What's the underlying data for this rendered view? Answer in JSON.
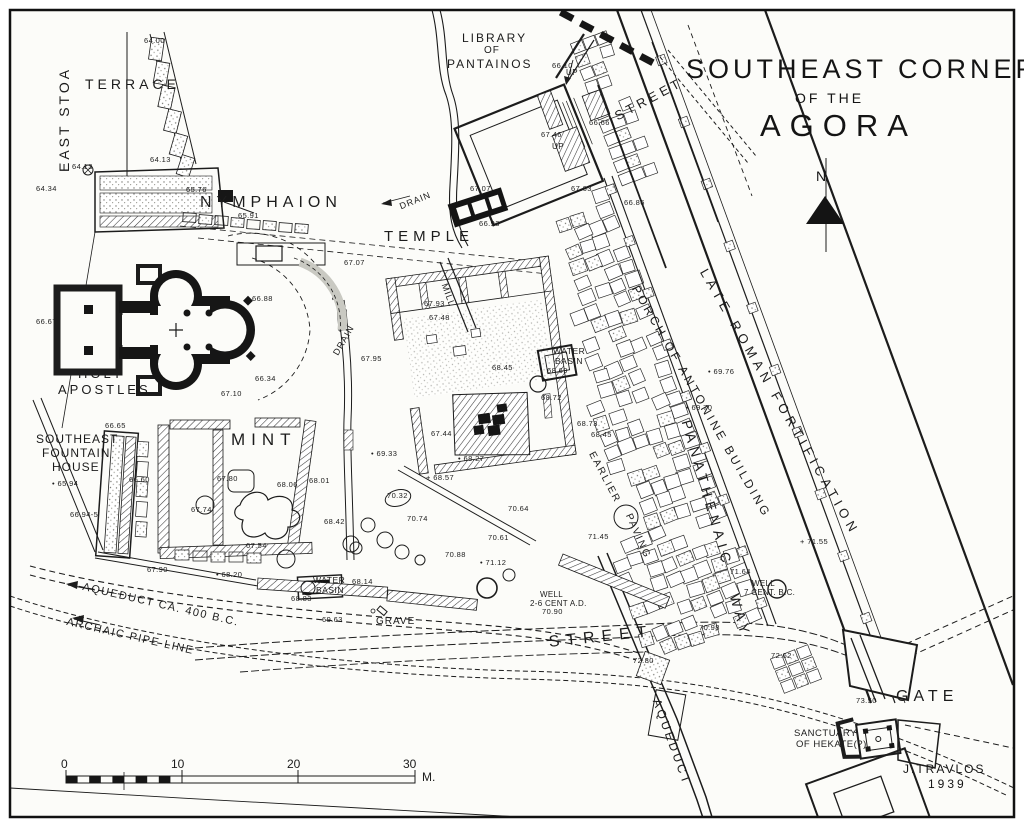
{
  "title": {
    "line1": "SOUTHEAST CORNER",
    "line2": "OF THE",
    "line3": "AGORA"
  },
  "compass": {
    "north": "N"
  },
  "attribution": {
    "author": "J.TRAVLOS",
    "year": "1939"
  },
  "scale_bar": {
    "unit": "M.",
    "ticks": [
      {
        "label": "0",
        "x": 61
      },
      {
        "label": "10",
        "x": 171
      },
      {
        "label": "20",
        "x": 287
      },
      {
        "label": "30",
        "x": 403
      }
    ]
  },
  "colors": {
    "ink": "#1c1c1c",
    "paper": "#fcfcf9"
  },
  "labels": [
    {
      "t": "EAST STOA",
      "x": 56,
      "y": 172,
      "r": -90,
      "s": 14,
      "ls": 3
    },
    {
      "t": "TERRACE",
      "x": 85,
      "y": 76,
      "s": 14,
      "ls": 4
    },
    {
      "t": "NYMPHAION",
      "x": 200,
      "y": 194,
      "s": 16,
      "ls": 5
    },
    {
      "t": "LIBRARY",
      "x": 462,
      "y": 31,
      "s": 12,
      "ls": 2
    },
    {
      "t": "OF",
      "x": 484,
      "y": 45,
      "s": 10,
      "ls": 1
    },
    {
      "t": "PANTAINOS",
      "x": 447,
      "y": 57,
      "s": 12,
      "ls": 2
    },
    {
      "t": "STREET",
      "x": 612,
      "y": 110,
      "r": -28,
      "s": 13,
      "ls": 4
    },
    {
      "t": "UP",
      "x": 566,
      "y": 68,
      "s": 8,
      "ls": 0.5
    },
    {
      "t": "UP",
      "x": 552,
      "y": 142,
      "s": 8,
      "ls": 0.5
    },
    {
      "t": "DRAIN",
      "x": 398,
      "y": 202,
      "r": -22,
      "s": 9,
      "ls": 1
    },
    {
      "t": "TEMPLE",
      "x": 384,
      "y": 228,
      "s": 15,
      "ls": 5
    },
    {
      "t": "MILL",
      "x": 449,
      "y": 282,
      "r": 70,
      "s": 9,
      "ls": 1
    },
    {
      "t": "DRAIN",
      "x": 331,
      "y": 352,
      "r": -60,
      "s": 9,
      "ls": 1
    },
    {
      "t": "HOLY",
      "x": 78,
      "y": 366,
      "s": 13,
      "ls": 3
    },
    {
      "t": "APOSTLES",
      "x": 58,
      "y": 382,
      "s": 13,
      "ls": 3
    },
    {
      "t": "SOUTHEAST",
      "x": 36,
      "y": 432,
      "s": 12,
      "ls": 1
    },
    {
      "t": "FOUNTAIN",
      "x": 42,
      "y": 446,
      "s": 12,
      "ls": 1
    },
    {
      "t": "HOUSE",
      "x": 52,
      "y": 460,
      "s": 12,
      "ls": 1
    },
    {
      "t": "MINT",
      "x": 231,
      "y": 430,
      "s": 17,
      "ls": 6
    },
    {
      "t": "WATER",
      "x": 553,
      "y": 346,
      "s": 8.5,
      "ls": 0.5
    },
    {
      "t": "BASIN",
      "x": 555,
      "y": 356,
      "s": 8.5,
      "ls": 0.5
    },
    {
      "t": "WATER",
      "x": 313,
      "y": 575,
      "s": 8.5,
      "ls": 0.5
    },
    {
      "t": "BASIN",
      "x": 316,
      "y": 585,
      "s": 8.5,
      "ls": 0.5
    },
    {
      "t": "PORCH OF ANTONINE BUILDING",
      "x": 641,
      "y": 283,
      "r": 60,
      "s": 12,
      "ls": 3
    },
    {
      "t": "LATE ROMAN FORTIFICATION",
      "x": 710,
      "y": 266,
      "r": 60,
      "s": 13,
      "ls": 5
    },
    {
      "t": "EARLIER",
      "x": 596,
      "y": 450,
      "r": 62,
      "s": 10,
      "ls": 2
    },
    {
      "t": "PAVING",
      "x": 633,
      "y": 512,
      "r": 66,
      "s": 10,
      "ls": 2
    },
    {
      "t": "PANATHENAIC",
      "x": 694,
      "y": 418,
      "r": 74,
      "s": 14,
      "ls": 5
    },
    {
      "t": "WAY",
      "x": 742,
      "y": 592,
      "r": 74,
      "s": 14,
      "ls": 5
    },
    {
      "t": "WELL",
      "x": 540,
      "y": 590,
      "s": 8,
      "ls": 0.3
    },
    {
      "t": "2-6 CENT A.D.",
      "x": 530,
      "y": 599,
      "s": 8,
      "ls": 0.3
    },
    {
      "t": "WELL",
      "x": 752,
      "y": 579,
      "s": 8,
      "ls": 0.3
    },
    {
      "t": "7 CENT. B.C.",
      "x": 744,
      "y": 588,
      "s": 8,
      "ls": 0.3
    },
    {
      "t": "GRAVE",
      "x": 376,
      "y": 616,
      "s": 10,
      "ls": 1
    },
    {
      "t": "STREET",
      "x": 548,
      "y": 634,
      "r": -6,
      "s": 16,
      "ls": 7
    },
    {
      "t": "AQUEDUCT CA. 400 B.C.",
      "x": 84,
      "y": 581,
      "r": 13,
      "s": 11,
      "ls": 1.5
    },
    {
      "t": "ARCHAIC PIPE LINE",
      "x": 68,
      "y": 616,
      "r": 13,
      "s": 11,
      "ls": 1.5
    },
    {
      "t": "AQUEDUCT",
      "x": 663,
      "y": 697,
      "r": 70,
      "s": 12,
      "ls": 3
    },
    {
      "t": "GATE",
      "x": 896,
      "y": 688,
      "s": 16,
      "ls": 5
    },
    {
      "t": "SANCTUARY",
      "x": 794,
      "y": 728,
      "s": 9.5,
      "ls": 0.5
    },
    {
      "t": "OF HEKATE(?)",
      "x": 796,
      "y": 739,
      "s": 9.5,
      "ls": 0.5
    }
  ],
  "elevations": [
    {
      "t": "64.00",
      "x": 144,
      "y": 36
    },
    {
      "t": "64.13",
      "x": 150,
      "y": 155
    },
    {
      "t": "64.13",
      "x": 72,
      "y": 162
    },
    {
      "t": "64.34",
      "x": 36,
      "y": 184
    },
    {
      "t": "65.76",
      "x": 186,
      "y": 185
    },
    {
      "t": "65.91",
      "x": 238,
      "y": 211
    },
    {
      "t": "66.10",
      "x": 552,
      "y": 61
    },
    {
      "t": "67.46",
      "x": 541,
      "y": 130
    },
    {
      "t": "66.66",
      "x": 589,
      "y": 118
    },
    {
      "t": "67.63",
      "x": 571,
      "y": 184
    },
    {
      "t": "66.86",
      "x": 624,
      "y": 198
    },
    {
      "t": "67.07",
      "x": 470,
      "y": 184
    },
    {
      "t": "66.93",
      "x": 479,
      "y": 219
    },
    {
      "t": "67.07",
      "x": 344,
      "y": 258
    },
    {
      "t": "66.88",
      "x": 252,
      "y": 294
    },
    {
      "t": "66.67",
      "x": 36,
      "y": 317
    },
    {
      "t": "66.34",
      "x": 255,
      "y": 374
    },
    {
      "t": "67.10",
      "x": 221,
      "y": 389
    },
    {
      "t": "66.65",
      "x": 105,
      "y": 421
    },
    {
      "t": "• 65.94",
      "x": 52,
      "y": 479
    },
    {
      "t": "66.60",
      "x": 129,
      "y": 475
    },
    {
      "t": "66.94-5",
      "x": 70,
      "y": 510
    },
    {
      "t": "67.80",
      "x": 217,
      "y": 474
    },
    {
      "t": "68.06",
      "x": 277,
      "y": 480
    },
    {
      "t": "68.01",
      "x": 309,
      "y": 476
    },
    {
      "t": "67.74",
      "x": 191,
      "y": 505
    },
    {
      "t": "67.54",
      "x": 246,
      "y": 541
    },
    {
      "t": "67.90",
      "x": 147,
      "y": 565
    },
    {
      "t": "• 68.20",
      "x": 216,
      "y": 570
    },
    {
      "t": "68.83",
      "x": 291,
      "y": 594
    },
    {
      "t": "69.63",
      "x": 322,
      "y": 615
    },
    {
      "t": "68.14",
      "x": 352,
      "y": 577
    },
    {
      "t": "68.42",
      "x": 324,
      "y": 517
    },
    {
      "t": "• 69.33",
      "x": 371,
      "y": 449
    },
    {
      "t": "67.95",
      "x": 361,
      "y": 354
    },
    {
      "t": "67.93",
      "x": 424,
      "y": 299
    },
    {
      "t": "67.48",
      "x": 429,
      "y": 313
    },
    {
      "t": "67.44",
      "x": 431,
      "y": 429
    },
    {
      "t": "+ 68.57",
      "x": 426,
      "y": 473
    },
    {
      "t": "• 68.27",
      "x": 458,
      "y": 454
    },
    {
      "t": "70.32",
      "x": 387,
      "y": 491
    },
    {
      "t": "70.74",
      "x": 407,
      "y": 514
    },
    {
      "t": "70.88",
      "x": 445,
      "y": 550
    },
    {
      "t": "• 71.12",
      "x": 480,
      "y": 558
    },
    {
      "t": "70.64",
      "x": 508,
      "y": 504
    },
    {
      "t": "70.61",
      "x": 488,
      "y": 533
    },
    {
      "t": "68.45",
      "x": 492,
      "y": 363
    },
    {
      "t": "68.69",
      "x": 547,
      "y": 366
    },
    {
      "t": "68.72",
      "x": 541,
      "y": 393
    },
    {
      "t": "68.73",
      "x": 577,
      "y": 419
    },
    {
      "t": "68.45",
      "x": 591,
      "y": 430
    },
    {
      "t": "• 69.76",
      "x": 708,
      "y": 367
    },
    {
      "t": "• 69.70",
      "x": 686,
      "y": 403
    },
    {
      "t": "+ 71.55",
      "x": 800,
      "y": 537
    },
    {
      "t": "71.45",
      "x": 588,
      "y": 532
    },
    {
      "t": "71.64",
      "x": 730,
      "y": 567
    },
    {
      "t": "70.98",
      "x": 699,
      "y": 623
    },
    {
      "t": "72.80",
      "x": 633,
      "y": 656
    },
    {
      "t": "72.62",
      "x": 771,
      "y": 651
    },
    {
      "t": "73.50",
      "x": 856,
      "y": 696
    },
    {
      "t": "70.90",
      "x": 542,
      "y": 607
    }
  ]
}
